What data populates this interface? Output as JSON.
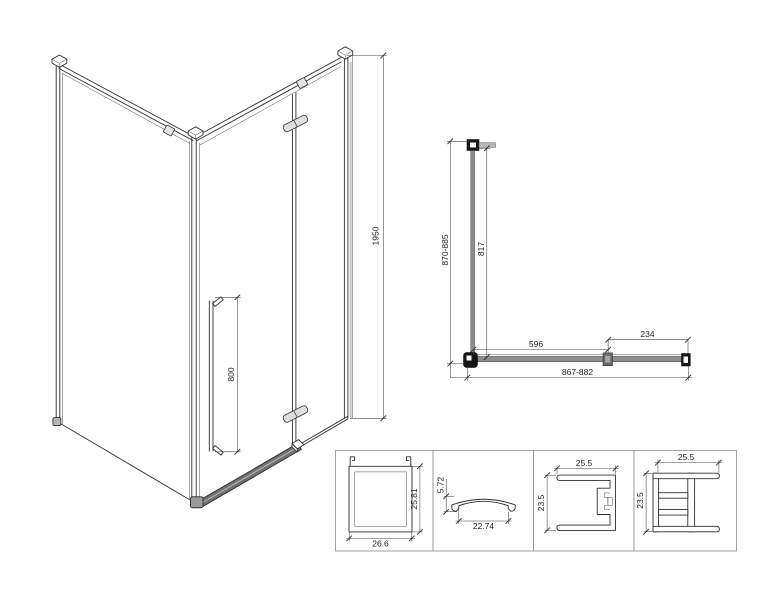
{
  "colors": {
    "line": "#2f2f2f",
    "glass_gray": "#8d8d8d",
    "rail_gray": "#6f6f6f",
    "fitting_black": "#151515",
    "hinge_gray": "#dedede",
    "cap_gray": "#ededed",
    "box_border": "#9a9a9a"
  },
  "iso": {
    "height_dim": "1950",
    "handle_dim": "800"
  },
  "plan": {
    "depth_dim": "870-885",
    "glass_dim": "817",
    "door_dim": "596",
    "panel_dim": "234",
    "width_dim": "867-882"
  },
  "profiles": [
    {
      "id": "glass-channel",
      "width_dim": "26.6",
      "height_dim": "25.81"
    },
    {
      "id": "threshold-cover",
      "width_dim": "22.74",
      "height_dim": "5.72"
    },
    {
      "id": "wall-profile",
      "width_dim": "25.5",
      "height_dim": "23.5"
    },
    {
      "id": "door-frame-profile",
      "width_dim": "25.5",
      "height_dim": "23.5"
    }
  ]
}
